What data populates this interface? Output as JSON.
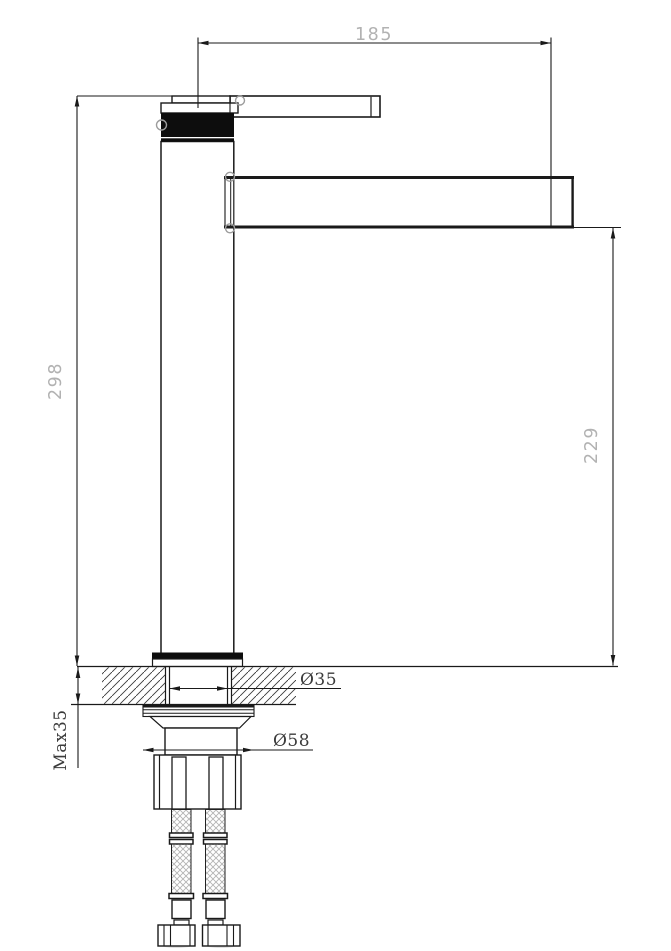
{
  "drawing": {
    "description": "faucet-technical-drawing-side-view",
    "dim_labels": {
      "spout_reach": "185",
      "total_height": "298",
      "spout_height": "229",
      "max_counter_thickness": "Max35",
      "shank_hole_diameter": "Ø35",
      "base_nut_diameter": "Ø58"
    }
  },
  "colors": {
    "line": "#1a1a1a",
    "dim-text-light": "#b2b2b2",
    "dim-text-dark": "#3b3b3b",
    "fill-black": "#0d0d0d",
    "braid": "#b3b3b3",
    "background": "#ffffff"
  }
}
